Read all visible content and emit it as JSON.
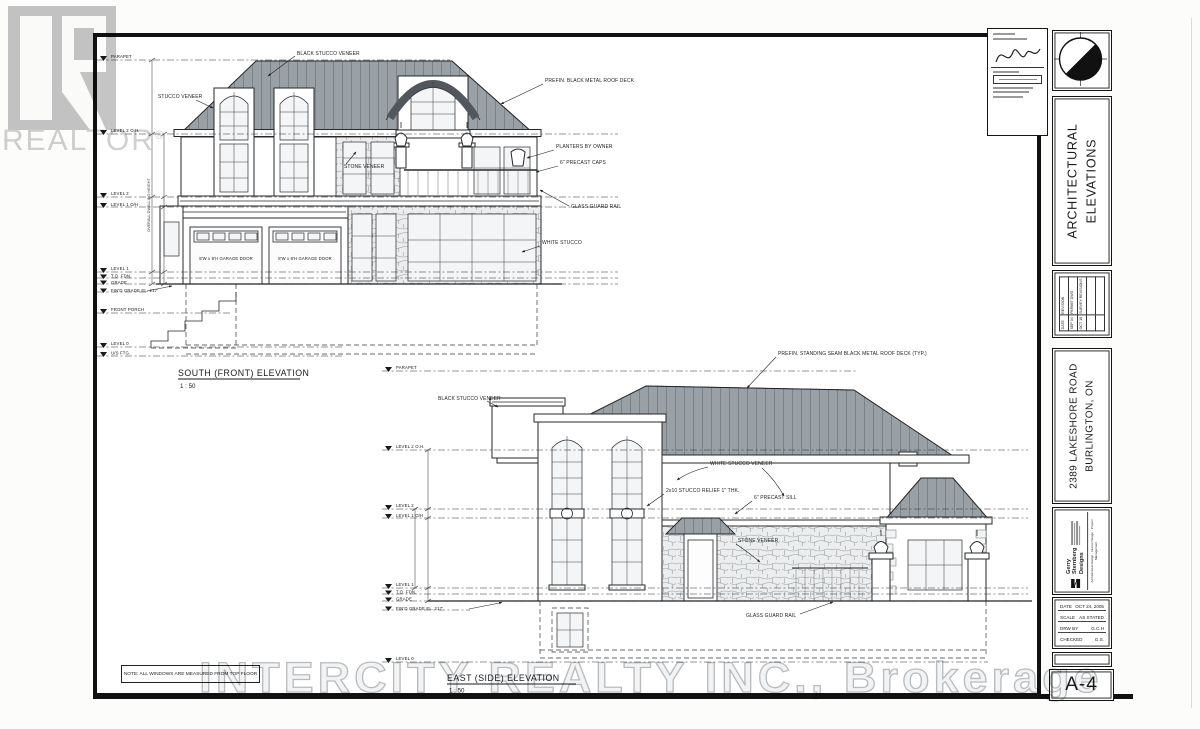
{
  "watermarks": {
    "realtor_logo_text": "REALTOR",
    "realtor_reg": "®",
    "brokerage": "INTERCITY REALTY INC., Brokerage"
  },
  "title_block": {
    "discipline_line1": "ARCHITECTURAL",
    "discipline_line2": "ELEVATIONS",
    "project_line1": "2389 LAKESHORE ROAD",
    "project_line2": "BURLINGTON, ON",
    "sheet_number": "A-4",
    "revisions": {
      "date_header": "DATE",
      "revision_header": "REVISION",
      "rows": [
        {
          "date": "SEP 04",
          "revision": "PERMIT DWG"
        },
        {
          "date": "OCT 18",
          "revision": "SURVEY REVISIONS"
        }
      ]
    },
    "designer": {
      "name_line1": "Gerry",
      "name_line2": "Sternberg",
      "name_line3": "Designs",
      "services": "Architectural Design · Interior Design · Project Management"
    },
    "info": {
      "rows": [
        {
          "label": "DATE",
          "value": "OCT 24, 2005"
        },
        {
          "label": "SCALE",
          "value": "AS STATED"
        },
        {
          "label": "DRW BY",
          "value": "G.C.H"
        },
        {
          "label": "CHECKED",
          "value": "G.S."
        }
      ]
    }
  },
  "note": "NOTE:  ALL WINDOWS ARE MEASURED FROM TOP FLOOR",
  "south_elevation": {
    "title": "SOUTH (FRONT) ELEVATION",
    "scale": "1 : 50",
    "levels": [
      "PARAPET",
      "LEVEL 2 O.H.",
      "LEVEL 2",
      "LEVEL 1 O/H",
      "LEVEL 1",
      "T.O. FDN.",
      "GRADE",
      "FIN'D GRADE EL. 217'",
      "FRONT PORCH",
      "LEVEL 0",
      "U/S FTG."
    ],
    "annotations": [
      "BLACK STUCCO VENEER",
      "PREFIN. BLACK METAL ROOF DECK",
      "STUCCO VENEER",
      "STONE VENEER",
      "PLANTERS BY OWNER",
      "6\" PRECAST CAPS",
      "GLASS GUARD RAIL",
      "WHITE STUCCO"
    ],
    "garage_door_label": "8'W x 8'H GARAGE DOOR",
    "dim_label": "OVERALL DWELLING HEIGHT"
  },
  "east_elevation": {
    "title": "EAST (SIDE) ELEVATION",
    "scale": "1 : 50",
    "levels": [
      "PARAPET",
      "LEVEL 2 O.H.",
      "LEVEL 2",
      "LEVEL 1 O/H",
      "LEVEL 1",
      "T.O. FDN.",
      "GRADE",
      "FIN'D GRADE EL. 217'",
      "LEVEL 0"
    ],
    "annotations": [
      "PREFIN. STANDING SEAM BLACK METAL ROOF DECK (TYP.)",
      "BLACK STUCCO VENEER",
      "WHITE STUCCO VENEER",
      "2x10 STUCCO RELIEF 1\" THK.",
      "6\" PRECAST SILL",
      "STONE VENEER",
      "GLASS GUARD RAIL"
    ]
  }
}
